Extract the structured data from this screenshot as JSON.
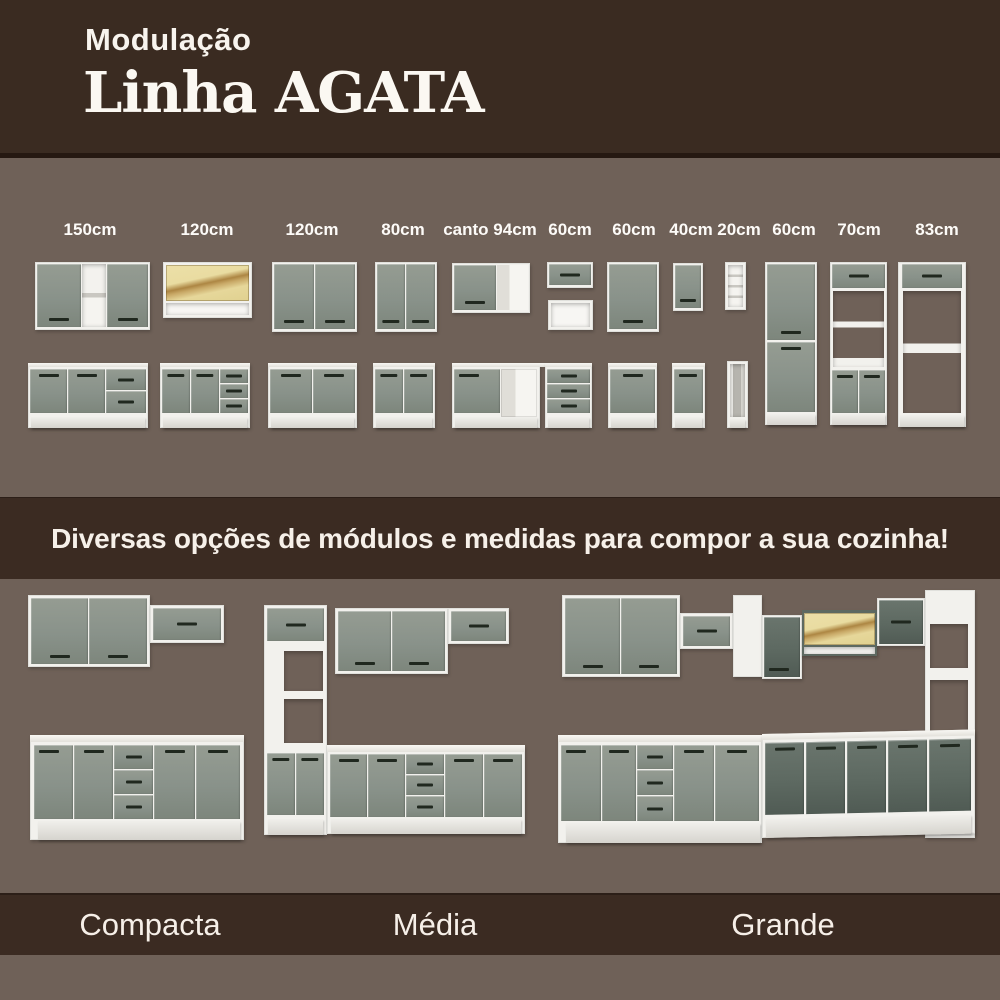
{
  "header": {
    "kicker": "Modulação",
    "title": "Linha AGATA"
  },
  "modules": {
    "labels": [
      "150cm",
      "120cm",
      "120cm",
      "80cm",
      "canto 94cm",
      "60cm",
      "60cm",
      "40cm",
      "20cm",
      "60cm",
      "70cm",
      "83cm"
    ]
  },
  "banner": {
    "text": "Diversas opções de módulos e medidas para compor a sua cozinha!"
  },
  "kitchens": {
    "items": [
      {
        "label": "Compacta"
      },
      {
        "label": "Média"
      },
      {
        "label": "Grande"
      }
    ]
  },
  "colors": {
    "header_brown": "#3A2B21",
    "divider_brown": "#251811",
    "banner_brown": "#3B2B22",
    "background_mauve": "#6F6158",
    "cabinet_gray": "#8B9289",
    "cabinet_dark_gray": "#5D6961",
    "frame_white": "#F2F1ED",
    "glass_yellow": "#E9DDA4",
    "handle_black": "#20281F"
  }
}
